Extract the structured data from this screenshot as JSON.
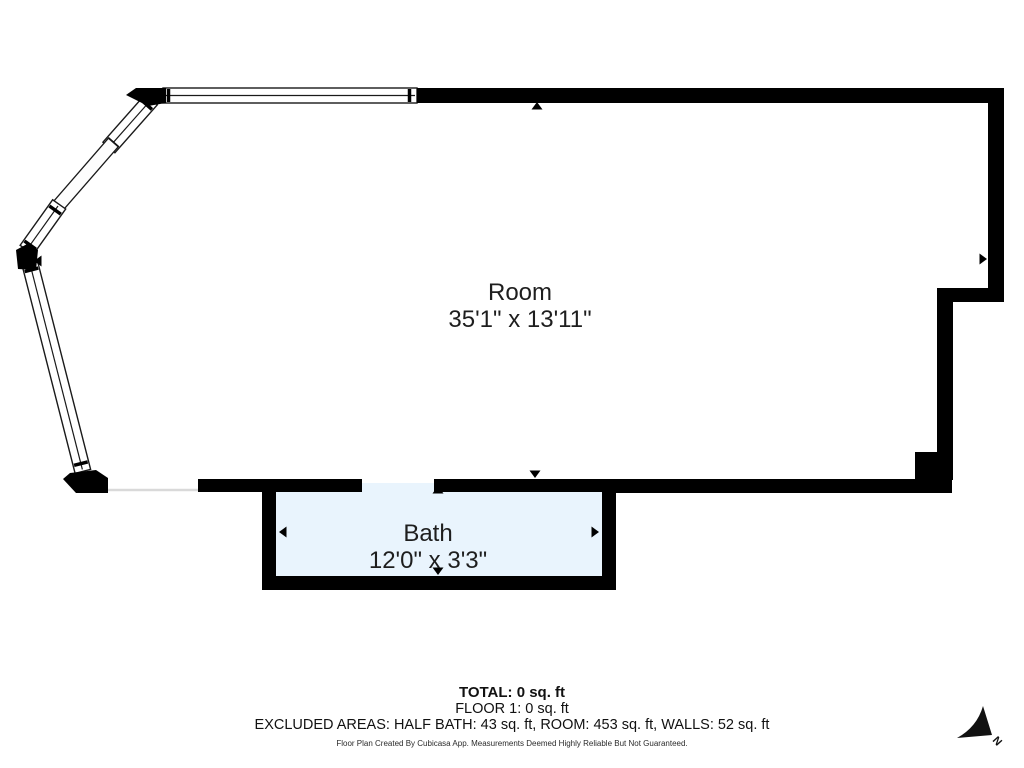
{
  "plan": {
    "rooms": [
      {
        "name": "Room",
        "dimensions": "35'1\" x 13'11\""
      },
      {
        "name": "Bath",
        "dimensions": "12'0\" x 3'3\""
      }
    ],
    "north_label": "N"
  },
  "summary": {
    "total": "TOTAL: 0 sq. ft",
    "floor": "FLOOR 1: 0 sq. ft",
    "excluded": "EXCLUDED AREAS: HALF BATH: 43 sq. ft, ROOM: 453 sq. ft, WALLS: 52 sq. ft",
    "disclaimer": "Floor Plan Created By Cubicasa App. Measurements Deemed Highly Reliable But Not Guaranteed."
  },
  "colors": {
    "wall": "#000000",
    "bath_fill": "#e9f4fd",
    "text": "#1f1f1f",
    "background": "#ffffff"
  }
}
